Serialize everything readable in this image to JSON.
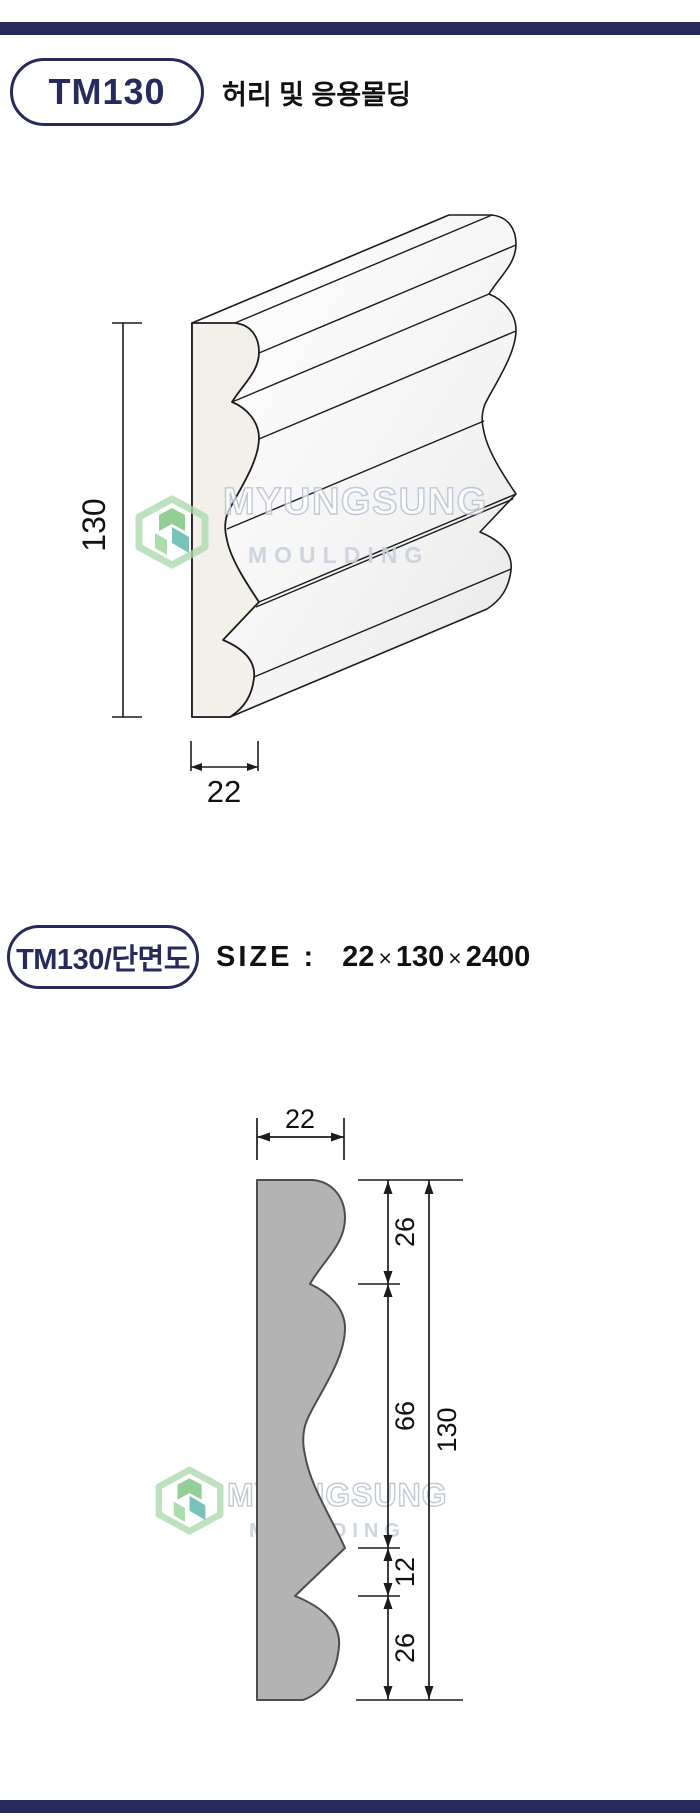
{
  "colors": {
    "accent_navy": "#272b5c",
    "outline_black": "#1c1c1c",
    "profile_gray": "#b3b3b3",
    "profile_gray_stroke": "#4d4d4d",
    "front_face_cream": "#f2f0e8",
    "watermark_letter": "#b9c4d2",
    "logo_green": "#69bd6e",
    "logo_green_light": "#a9d8ac",
    "logo_teal": "#43aa9f"
  },
  "header": {
    "code": "TM130",
    "title": "허리 및 응용몰딩"
  },
  "drawing1": {
    "height_label": "130",
    "width_label": "22"
  },
  "section2": {
    "code": "TM130/단면도",
    "size_label": "SIZE :",
    "times": "×",
    "dim_w": "22",
    "dim_h": "130",
    "dim_l": "2400"
  },
  "drawing2": {
    "width_label": "22",
    "seg_top": "26",
    "seg_mid": "66",
    "seg_notch": "12",
    "seg_bottom": "26",
    "total_label": "130"
  },
  "watermark": {
    "brand": "MYUNGSUNG",
    "sub": "MOULDING"
  }
}
